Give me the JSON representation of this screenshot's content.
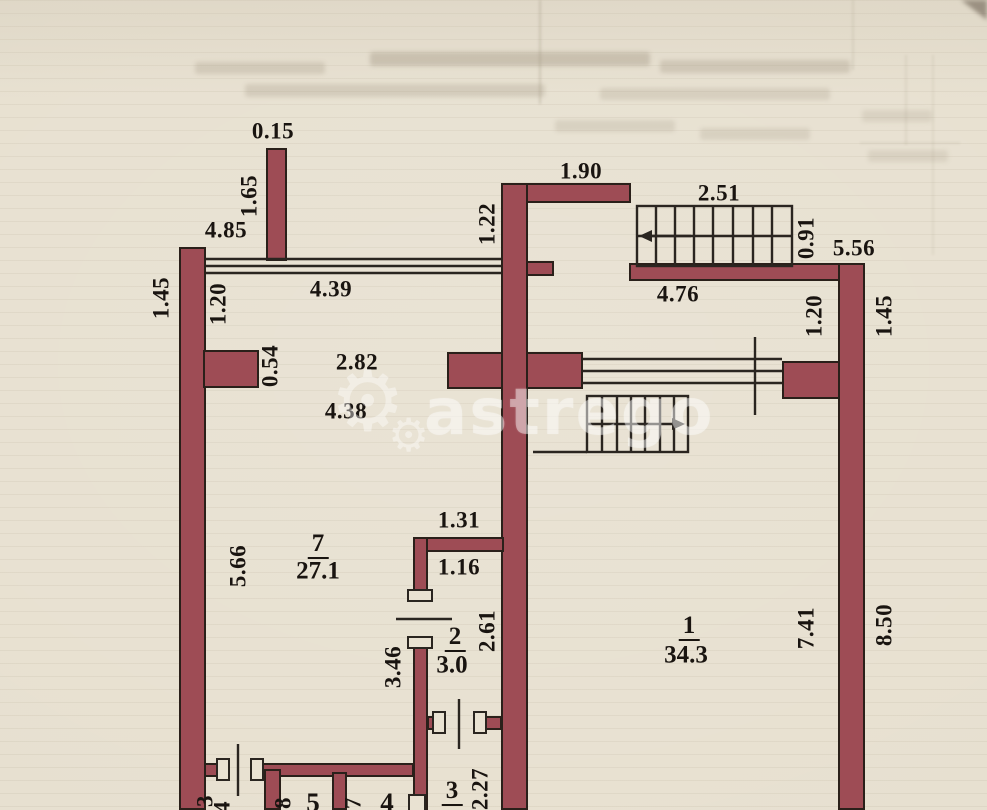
{
  "watermark": {
    "text": "astrego"
  },
  "rooms": [
    {
      "number": "7",
      "area": "27.1"
    },
    {
      "number": "2",
      "area": "3.0"
    },
    {
      "number": "1",
      "area": "34.3"
    },
    {
      "number": "3"
    },
    {
      "number": "5"
    },
    {
      "number": "4"
    }
  ],
  "labels": [
    {
      "id": "dim-0-15",
      "text": "0.15",
      "x": 273,
      "y": 131,
      "cls": "dim"
    },
    {
      "id": "dim-4-85",
      "text": "4.85",
      "x": 226,
      "y": 230,
      "cls": "dim"
    },
    {
      "id": "dim-4-39",
      "text": "4.39",
      "x": 331,
      "y": 289,
      "cls": "dim"
    },
    {
      "id": "dim-1-90",
      "text": "1.90",
      "x": 581,
      "y": 171,
      "cls": "dim"
    },
    {
      "id": "dim-2-51",
      "text": "2.51",
      "x": 719,
      "y": 193,
      "cls": "dim"
    },
    {
      "id": "dim-4-76",
      "text": "4.76",
      "x": 678,
      "y": 294,
      "cls": "dim"
    },
    {
      "id": "dim-5-56",
      "text": "5.56",
      "x": 854,
      "y": 248,
      "cls": "dim"
    },
    {
      "id": "dim-2-82",
      "text": "2.82",
      "x": 357,
      "y": 362,
      "cls": "dim"
    },
    {
      "id": "dim-4-38",
      "text": "4.38",
      "x": 346,
      "y": 411,
      "cls": "dim"
    },
    {
      "id": "dim-1-31",
      "text": "1.31",
      "x": 459,
      "y": 520,
      "cls": "dim"
    },
    {
      "id": "dim-1-16",
      "text": "1.16",
      "x": 459,
      "y": 567,
      "cls": "dim"
    },
    {
      "id": "dim-1-65",
      "text": "1.65",
      "x": 249,
      "y": 196,
      "cls": "dim rot"
    },
    {
      "id": "dim-1-45-left",
      "text": "1.45",
      "x": 161,
      "y": 298,
      "cls": "dim rot"
    },
    {
      "id": "dim-1-20-left",
      "text": "1.20",
      "x": 218,
      "y": 304,
      "cls": "dim rot"
    },
    {
      "id": "dim-0-54",
      "text": "0.54",
      "x": 270,
      "y": 366,
      "cls": "dim rot"
    },
    {
      "id": "dim-1-22",
      "text": "1.22",
      "x": 487,
      "y": 224,
      "cls": "dim rot"
    },
    {
      "id": "dim-0-91",
      "text": "0.91",
      "x": 806,
      "y": 238,
      "cls": "dim rot"
    },
    {
      "id": "dim-1-20-right",
      "text": "1.20",
      "x": 814,
      "y": 316,
      "cls": "dim rot"
    },
    {
      "id": "dim-1-45-right",
      "text": "1.45",
      "x": 884,
      "y": 316,
      "cls": "dim rot"
    },
    {
      "id": "dim-5-66",
      "text": "5.66",
      "x": 238,
      "y": 566,
      "cls": "dim rot"
    },
    {
      "id": "dim-3-46",
      "text": "3.46",
      "x": 393,
      "y": 667,
      "cls": "dim rot"
    },
    {
      "id": "dim-2-61",
      "text": "2.61",
      "x": 487,
      "y": 631,
      "cls": "dim rot"
    },
    {
      "id": "dim-7-41",
      "text": "7.41",
      "x": 806,
      "y": 628,
      "cls": "dim rot"
    },
    {
      "id": "dim-8-50",
      "text": "8.50",
      "x": 884,
      "y": 625,
      "cls": "dim rot"
    },
    {
      "id": "dim-2-27",
      "text": "2.27",
      "x": 480,
      "y": 789,
      "cls": "dim rot"
    },
    {
      "id": "dim-8-part",
      "text": "8",
      "x": 283,
      "y": 803,
      "cls": "dim rot"
    },
    {
      "id": "dim-7-part",
      "text": "7",
      "x": 353,
      "y": 803,
      "cls": "dim rot"
    },
    {
      "id": "dim-3-part",
      "text": "3",
      "x": 205,
      "y": 801,
      "cls": "dim rot"
    },
    {
      "id": "dim-4-part",
      "text": "4",
      "x": 222,
      "y": 807,
      "cls": "dim rot"
    },
    {
      "id": "room-7-number",
      "text": "7",
      "x": 318,
      "y": 545,
      "cls": "room-num"
    },
    {
      "id": "room-7-area",
      "text": "27.1",
      "x": 318,
      "y": 571,
      "cls": "room-area"
    },
    {
      "id": "room-2-number",
      "text": "2",
      "x": 455,
      "y": 638,
      "cls": "room-num"
    },
    {
      "id": "room-2-area",
      "text": "3.0",
      "x": 452,
      "y": 665,
      "cls": "room-area"
    },
    {
      "id": "room-1-number",
      "text": "1",
      "x": 689,
      "y": 627,
      "cls": "room-num"
    },
    {
      "id": "room-1-area",
      "text": "34.3",
      "x": 686,
      "y": 655,
      "cls": "room-area"
    },
    {
      "id": "room-3-number",
      "text": "3",
      "x": 452,
      "y": 792,
      "cls": "room-num"
    },
    {
      "id": "room-5-number",
      "text": "5",
      "x": 313,
      "y": 803,
      "cls": "room-num-plain"
    },
    {
      "id": "room-4-number",
      "text": "4",
      "x": 387,
      "y": 803,
      "cls": "room-num-plain"
    }
  ]
}
